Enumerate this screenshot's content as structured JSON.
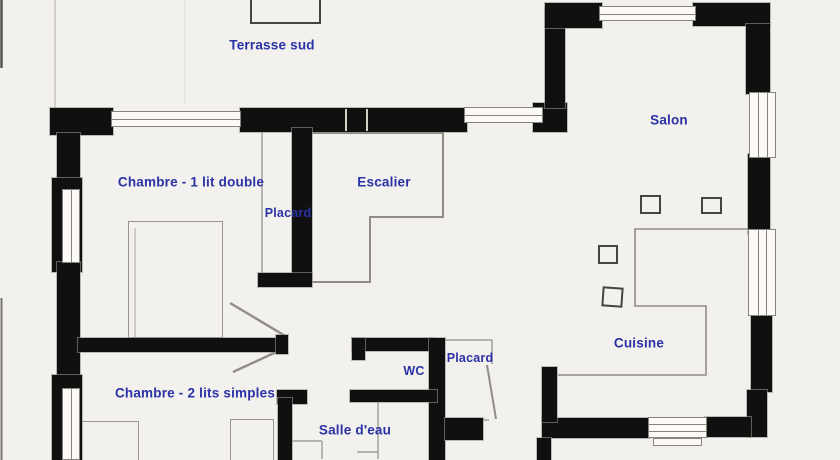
{
  "title": "Plan de maison (rez-de-chaussee)",
  "colors": {
    "paper": "#f2f1ed",
    "wall": "#101010",
    "label": "#2a32a6",
    "pencil": "#8f8d85"
  },
  "rooms": {
    "terrasse": {
      "label": "Terrasse sud"
    },
    "chambre1": {
      "label": "Chambre - 1 lit double"
    },
    "escalier": {
      "label": "Escalier"
    },
    "placard1": {
      "label": "Placard"
    },
    "salon": {
      "label": "Salon"
    },
    "cuisine": {
      "label": "Cuisine"
    },
    "placard2": {
      "label": "Placard"
    },
    "wc": {
      "label": "WC"
    },
    "chambre2": {
      "label": "Chambre - 2 lits simples"
    },
    "salle_eau": {
      "label": "Salle d'eau"
    }
  }
}
